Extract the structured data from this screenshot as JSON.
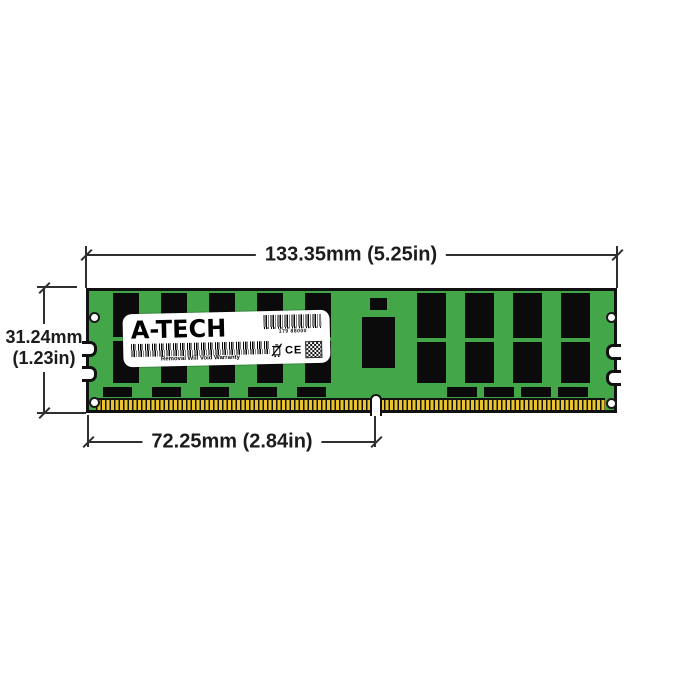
{
  "diagram": {
    "kind": "ram-module-dimension-diagram",
    "dimensions": {
      "width_label": "133.35mm (5.25in)",
      "height_label_mm": "31.24mm",
      "height_label_in": "(1.23in)",
      "pin_offset_label": "72.25mm (2.84in)"
    },
    "module_label": {
      "brand": "A-TECH",
      "part_number": "179 88000",
      "warranty": "Removal Will Void Warranty",
      "ce_mark": "CE"
    },
    "colors": {
      "pcb_green": "#43A74A",
      "chip_black": "#0B0B0B",
      "pin_gold": "#E8C52F",
      "line_dark": "#2F2F2F"
    }
  }
}
